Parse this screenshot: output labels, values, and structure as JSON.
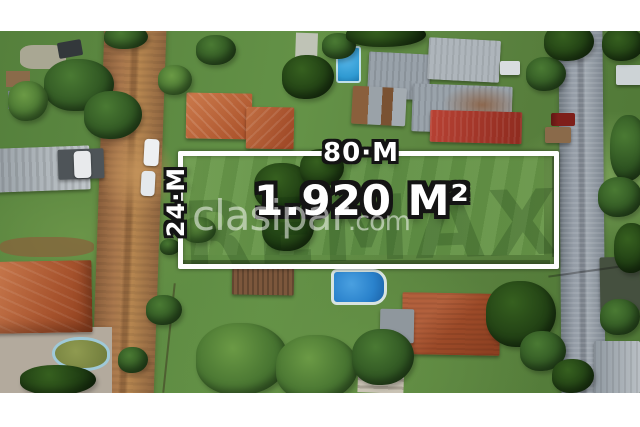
{
  "overlay": {
    "frontage_label": "80·M",
    "depth_label": "24·M",
    "area_label": "1.920 M²"
  },
  "watermarks": {
    "site_name": "clasipar",
    "site_tld": ".com",
    "brand": "REMAX"
  },
  "colors": {
    "plot_outline": "#ffffff",
    "label_fill": "#ffffff",
    "label_outline": "#141414",
    "watermark_white": "rgba(255,255,255,0.52)",
    "brand_watermark_green": "rgba(8,40,8,0.2)"
  }
}
